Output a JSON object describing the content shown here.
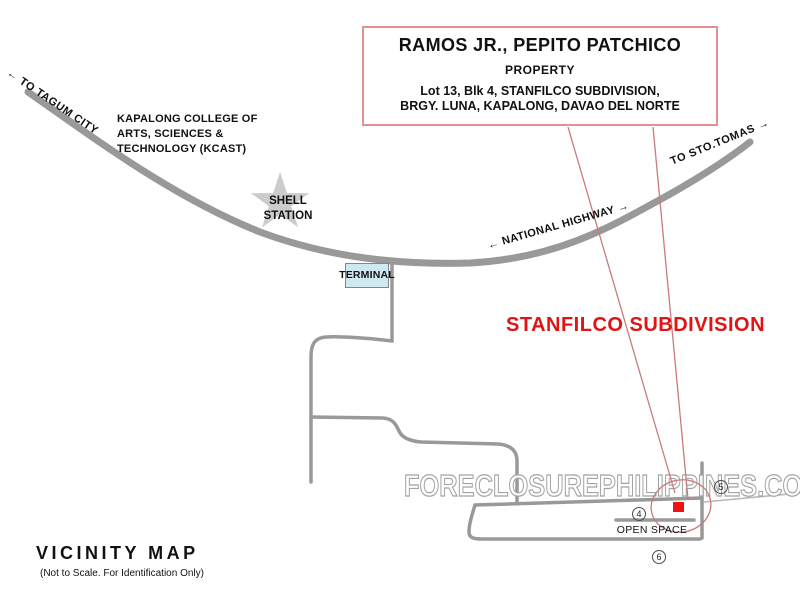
{
  "title_box": {
    "owner": "RAMOS JR., PEPITO PATCHICO",
    "subtitle": "PROPERTY",
    "address_line1": "Lot 13, Blk 4, STANFILCO SUBDIVISION,",
    "address_line2": "BRGY. LUNA, KAPALONG, DAVAO DEL NORTE"
  },
  "road_labels": {
    "to_tagum": "←  TO TAGUM CITY",
    "to_sto_tomas": "TO STO.TOMAS  →",
    "national_highway": "←  NATIONAL HIGHWAY  →"
  },
  "landmarks": {
    "college_line1": "KAPALONG COLLEGE OF",
    "college_line2": "ARTS, SCIENCES &",
    "college_line3": "TECHNOLOGY (KCAST)",
    "shell_line1": "SHELL",
    "shell_line2": "STATION",
    "shell_star_glyph": "★",
    "terminal": "TERMINAL",
    "subdivision": "STANFILCO SUBDIVISION",
    "open_space": "OPEN SPACE"
  },
  "block_numbers": {
    "b4": "4",
    "b5": "5",
    "b6": "6"
  },
  "watermark": "FORECLOSUREPHILIPPINES.COM",
  "footer": {
    "title": "VICINITY MAP",
    "note": "(Not to Scale. For Identification Only)"
  },
  "colors": {
    "road_gray": "#999999",
    "boundary_gray": "#b8b8b8",
    "box_border_red": "#e59090",
    "callout_red": "#c97b7b",
    "marker_red": "#ee1212",
    "subdivision_text_red": "#e01414",
    "terminal_fill": "#cfe9f2",
    "star_gray": "#cccccc"
  }
}
